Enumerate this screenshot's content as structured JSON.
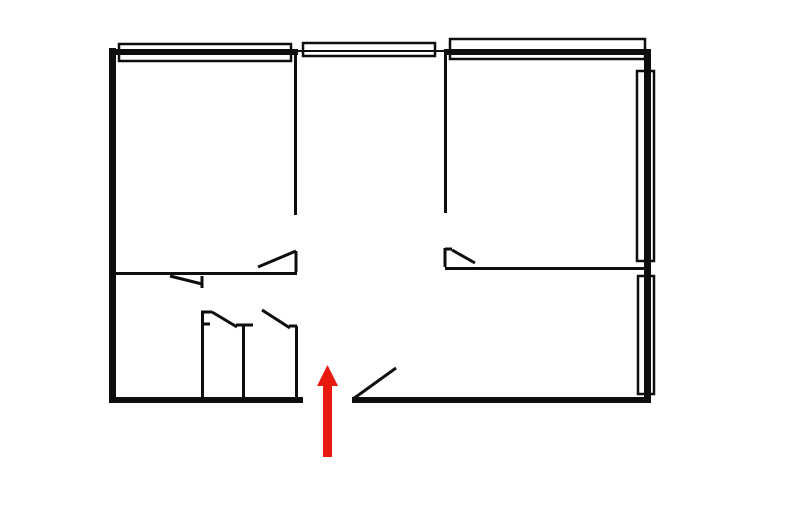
{
  "meta": {
    "description": "Apartment floor plan sketch with a red arrow marking the entrance opening in the bottom wall"
  },
  "canvas": {
    "width": 800,
    "height": 526
  },
  "colors": {
    "background": "#ffffff",
    "wall": "#0e0e0e",
    "arrow_red": "#e8190f"
  },
  "plan": {
    "outer_walls": [
      {
        "name": "left-wall",
        "x": 109,
        "y": 48,
        "w": 7,
        "h": 354
      },
      {
        "name": "top-wall-left",
        "x": 109,
        "y": 49,
        "w": 189,
        "h": 6
      },
      {
        "name": "top-wall-right",
        "x": 444,
        "y": 49,
        "w": 207,
        "h": 6
      },
      {
        "name": "right-wall",
        "x": 644,
        "y": 49,
        "w": 7,
        "h": 353
      },
      {
        "name": "bottom-wall-left",
        "x": 109,
        "y": 397,
        "w": 194,
        "h": 6
      },
      {
        "name": "bottom-wall-right",
        "x": 352,
        "y": 397,
        "w": 299,
        "h": 6
      }
    ],
    "thin_walls": [
      {
        "name": "top-wall-thin-middle",
        "x1": 297,
        "y1": 51,
        "x2": 450,
        "y2": 51,
        "t": 2
      },
      {
        "name": "interior-wall-left-vertical",
        "x1": 295.5,
        "y1": 55,
        "x2": 295.5,
        "y2": 215,
        "t": 3
      },
      {
        "name": "interior-wall-right-vertical",
        "x1": 445.5,
        "y1": 55,
        "x2": 445.5,
        "y2": 213,
        "t": 3
      },
      {
        "name": "interior-wall-left-horizontal",
        "x1": 112,
        "y1": 273.5,
        "x2": 297,
        "y2": 273.5,
        "t": 3
      },
      {
        "name": "interior-wall-right-horizontal",
        "x1": 445,
        "y1": 268.5,
        "x2": 647,
        "y2": 268.5,
        "t": 3
      },
      {
        "name": "bathroom-left-wall",
        "x1": 202.5,
        "y1": 312,
        "x2": 202.5,
        "y2": 399,
        "t": 3
      },
      {
        "name": "bathroom-middle-wall",
        "x1": 243.5,
        "y1": 325,
        "x2": 243.5,
        "y2": 399,
        "t": 3
      },
      {
        "name": "bathroom-right-wall",
        "x1": 296.5,
        "y1": 326,
        "x2": 296.5,
        "y2": 399,
        "t": 3
      }
    ],
    "windows": [
      {
        "name": "window-top-left",
        "x": 119,
        "y": 44,
        "w": 172,
        "h": 17
      },
      {
        "name": "window-top-middle",
        "x": 303,
        "y": 43,
        "w": 132,
        "h": 13
      },
      {
        "name": "window-top-right",
        "x": 450,
        "y": 39,
        "w": 195,
        "h": 20
      },
      {
        "name": "window-right-upper",
        "x": 637,
        "y": 71,
        "w": 17,
        "h": 190
      },
      {
        "name": "window-right-lower",
        "x": 638,
        "y": 276,
        "w": 16,
        "h": 118
      }
    ],
    "doors": [
      {
        "name": "door-left-room",
        "segments": [
          {
            "x1": 296,
            "y1": 251,
            "x2": 296,
            "y2": 272
          },
          {
            "x1": 258,
            "y1": 267,
            "x2": 296,
            "y2": 251
          }
        ]
      },
      {
        "name": "door-hallway",
        "segments": [
          {
            "x1": 170,
            "y1": 276,
            "x2": 202,
            "y2": 284
          },
          {
            "x1": 202,
            "y1": 276,
            "x2": 202,
            "y2": 288
          }
        ]
      },
      {
        "name": "door-right-room",
        "segments": [
          {
            "x1": 445,
            "y1": 248,
            "x2": 445,
            "y2": 267
          },
          {
            "x1": 445,
            "y1": 249,
            "x2": 452,
            "y2": 249
          },
          {
            "x1": 452,
            "y1": 250,
            "x2": 475,
            "y2": 263
          }
        ]
      },
      {
        "name": "door-wc",
        "segments": [
          {
            "x1": 201,
            "y1": 312,
            "x2": 212,
            "y2": 312
          },
          {
            "x1": 201,
            "y1": 324,
            "x2": 210,
            "y2": 324
          },
          {
            "x1": 212,
            "y1": 312,
            "x2": 237,
            "y2": 327
          },
          {
            "x1": 236,
            "y1": 325,
            "x2": 253,
            "y2": 325
          }
        ]
      },
      {
        "name": "door-bathroom",
        "segments": [
          {
            "x1": 262,
            "y1": 310,
            "x2": 290,
            "y2": 328
          },
          {
            "x1": 289,
            "y1": 326,
            "x2": 297,
            "y2": 326
          }
        ]
      },
      {
        "name": "door-entrance",
        "segments": [
          {
            "x1": 353,
            "y1": 399,
            "x2": 396,
            "y2": 368
          }
        ]
      }
    ],
    "entrance_arrow": {
      "cx": 327.5,
      "tip_y": 365,
      "head_base_y": 386,
      "head_half_width": 10.5,
      "shaft_width": 9,
      "shaft_bottom_y": 457
    }
  }
}
